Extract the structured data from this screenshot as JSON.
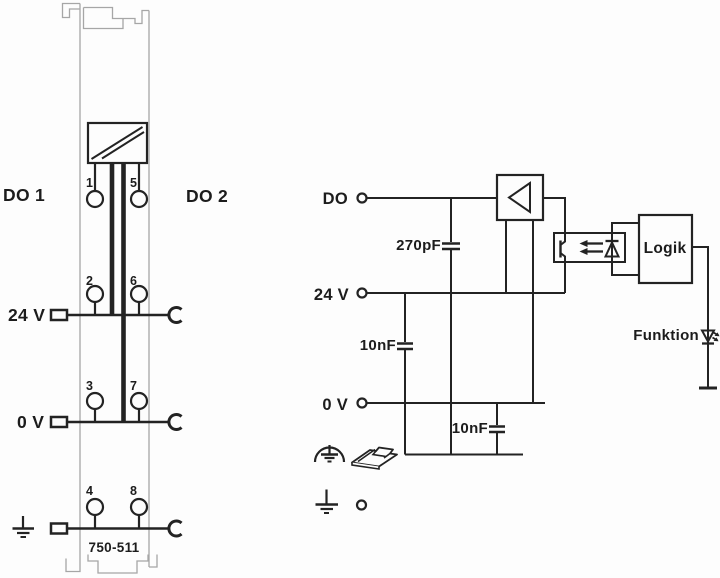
{
  "diagram": {
    "title": "750-511 digital output module wiring diagram",
    "module": {
      "label_do1": "DO 1",
      "label_do2": "DO 2",
      "label_24v": "24 V",
      "label_0v": "0 V",
      "part_number": "750-511",
      "terminals": [
        "1",
        "5",
        "2",
        "6",
        "3",
        "7",
        "4",
        "8"
      ]
    },
    "schematic": {
      "label_do": "DO",
      "label_24v": "24 V",
      "label_0v": "0 V",
      "cap_do": "270pF",
      "cap_24v": "10nF",
      "cap_0v": "10nF",
      "logic_label": "Logik",
      "function_label": "Funktion"
    },
    "colors": {
      "line": "#232323",
      "module_outline": "#a6a6a6",
      "background": "#fdfdfd",
      "text": "#1c1c1c"
    }
  }
}
